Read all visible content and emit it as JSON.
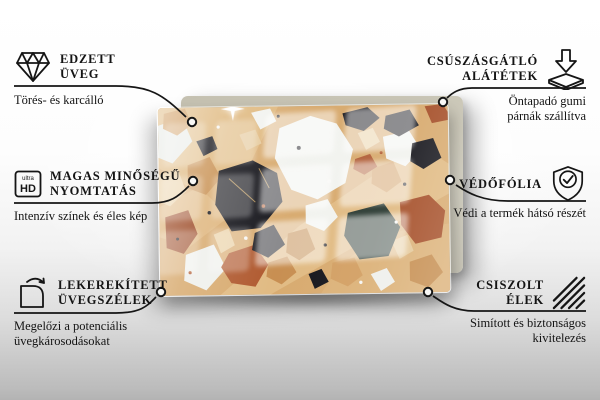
{
  "product": {
    "name": "terrazzo-glass-board",
    "pattern": "terrazzo",
    "board_color": "#cdc9ba",
    "palette": {
      "sand": "#d8ab70",
      "black": "#17171d",
      "dark_green": "#2b3a32",
      "white": "#f2f3ef",
      "rust": "#a6502a",
      "tan": "#c99254",
      "peach": "#ead0a4"
    }
  },
  "callouts": {
    "left": [
      {
        "icon": "diamond-icon",
        "title_lines": [
          "EDZETT",
          "ÜVEG"
        ],
        "subtitle_lines": [
          "Törés- és karcálló"
        ]
      },
      {
        "icon": "ultra-hd-icon",
        "icon_text_top": "ultra",
        "icon_text_bottom": "HD",
        "title_lines": [
          "MAGAS MINŐSÉGŰ",
          "NYOMTATÁS"
        ],
        "subtitle_lines": [
          "Intenzív színek és éles kép"
        ]
      },
      {
        "icon": "rounded-corner-icon",
        "title_lines": [
          "LEKEREKÍTETT",
          "ÜVEGSZÉLEK"
        ],
        "subtitle_lines": [
          "Megelőzi a potenciális",
          "üvegkárosodásokat"
        ]
      }
    ],
    "right": [
      {
        "icon": "anti-slip-pad-icon",
        "title_lines": [
          "CSÚSZÁSGÁTLÓ",
          "ALÁTÉTEK"
        ],
        "subtitle_lines": [
          "Öntapadó gumi",
          "párnák szállítva"
        ]
      },
      {
        "icon": "shield-check-icon",
        "title_lines": [
          "VÉDŐFÓLIA"
        ],
        "subtitle_lines": [
          "Védi a termék hátsó részét"
        ]
      },
      {
        "icon": "polished-edges-icon",
        "title_lines": [
          "CSISZOLT",
          "ÉLEK"
        ],
        "subtitle_lines": [
          "Simított és biztonságos",
          "kivitelezés"
        ]
      }
    ]
  }
}
